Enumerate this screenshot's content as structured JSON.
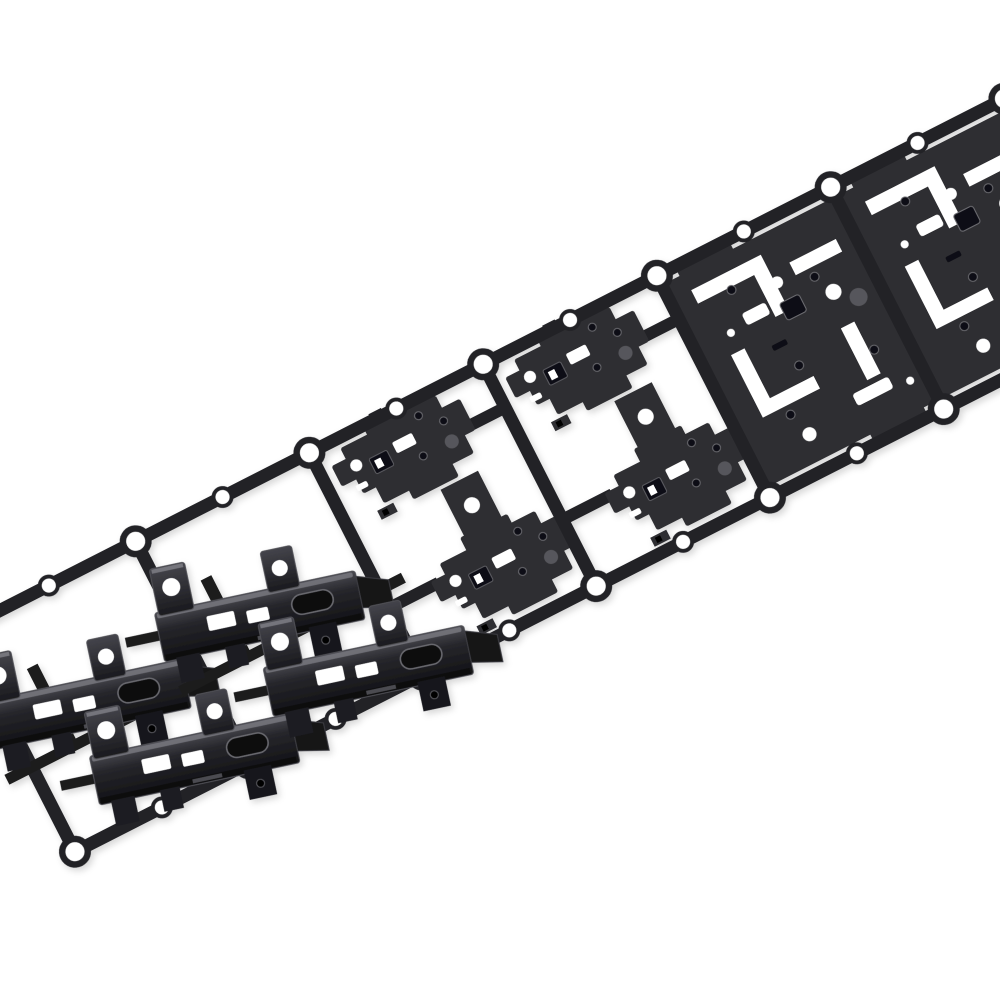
{
  "scene": {
    "description": "Close-up product photograph of black stamped sheet-metal hinge brackets attached to a continuous progressive-die carrier strip. The strip runs diagonally from the lower-left to the upper-right corner over a plain white background. Cells at the lower-left hold fully formed, bent-up brackets; middle cells hold flat stepped blanks; upper-right cells are dense, nearly solid blanks with lace-like white punched cutouts.",
    "object": "progressive die stamping carrier strip with hinge bracket parts",
    "finish": "matte black coated steel",
    "background": "plain white seamless"
  },
  "colors": {
    "background": "#ffffff",
    "metal": "#2e2e32",
    "metal_dark": "#1c1c1f",
    "rail": "#232327",
    "highlight": "#7b7b82",
    "hole_rim": "#6a6a70",
    "deep": "#0f0f12",
    "gray_disc": "#57575c"
  },
  "strip": {
    "angle_deg": -27,
    "origin": {
      "x": -35,
      "y": 768
    },
    "pitch": 195,
    "start_x": 60,
    "band_half": 118,
    "rail_thickness": 13,
    "cross_rail_width": 13,
    "pilot_hole_radius": 9.5,
    "pilot_pad_radius": 16,
    "mid_hole_radius": 7,
    "parts_per_cell": 2,
    "cells": [
      {
        "stage": "formed"
      },
      {
        "stage": "formed"
      },
      {
        "stage": "sparse"
      },
      {
        "stage": "sparse"
      },
      {
        "stage": "dense"
      },
      {
        "stage": "dense"
      },
      {
        "stage": "dense"
      },
      {
        "stage": "dense"
      }
    ]
  }
}
